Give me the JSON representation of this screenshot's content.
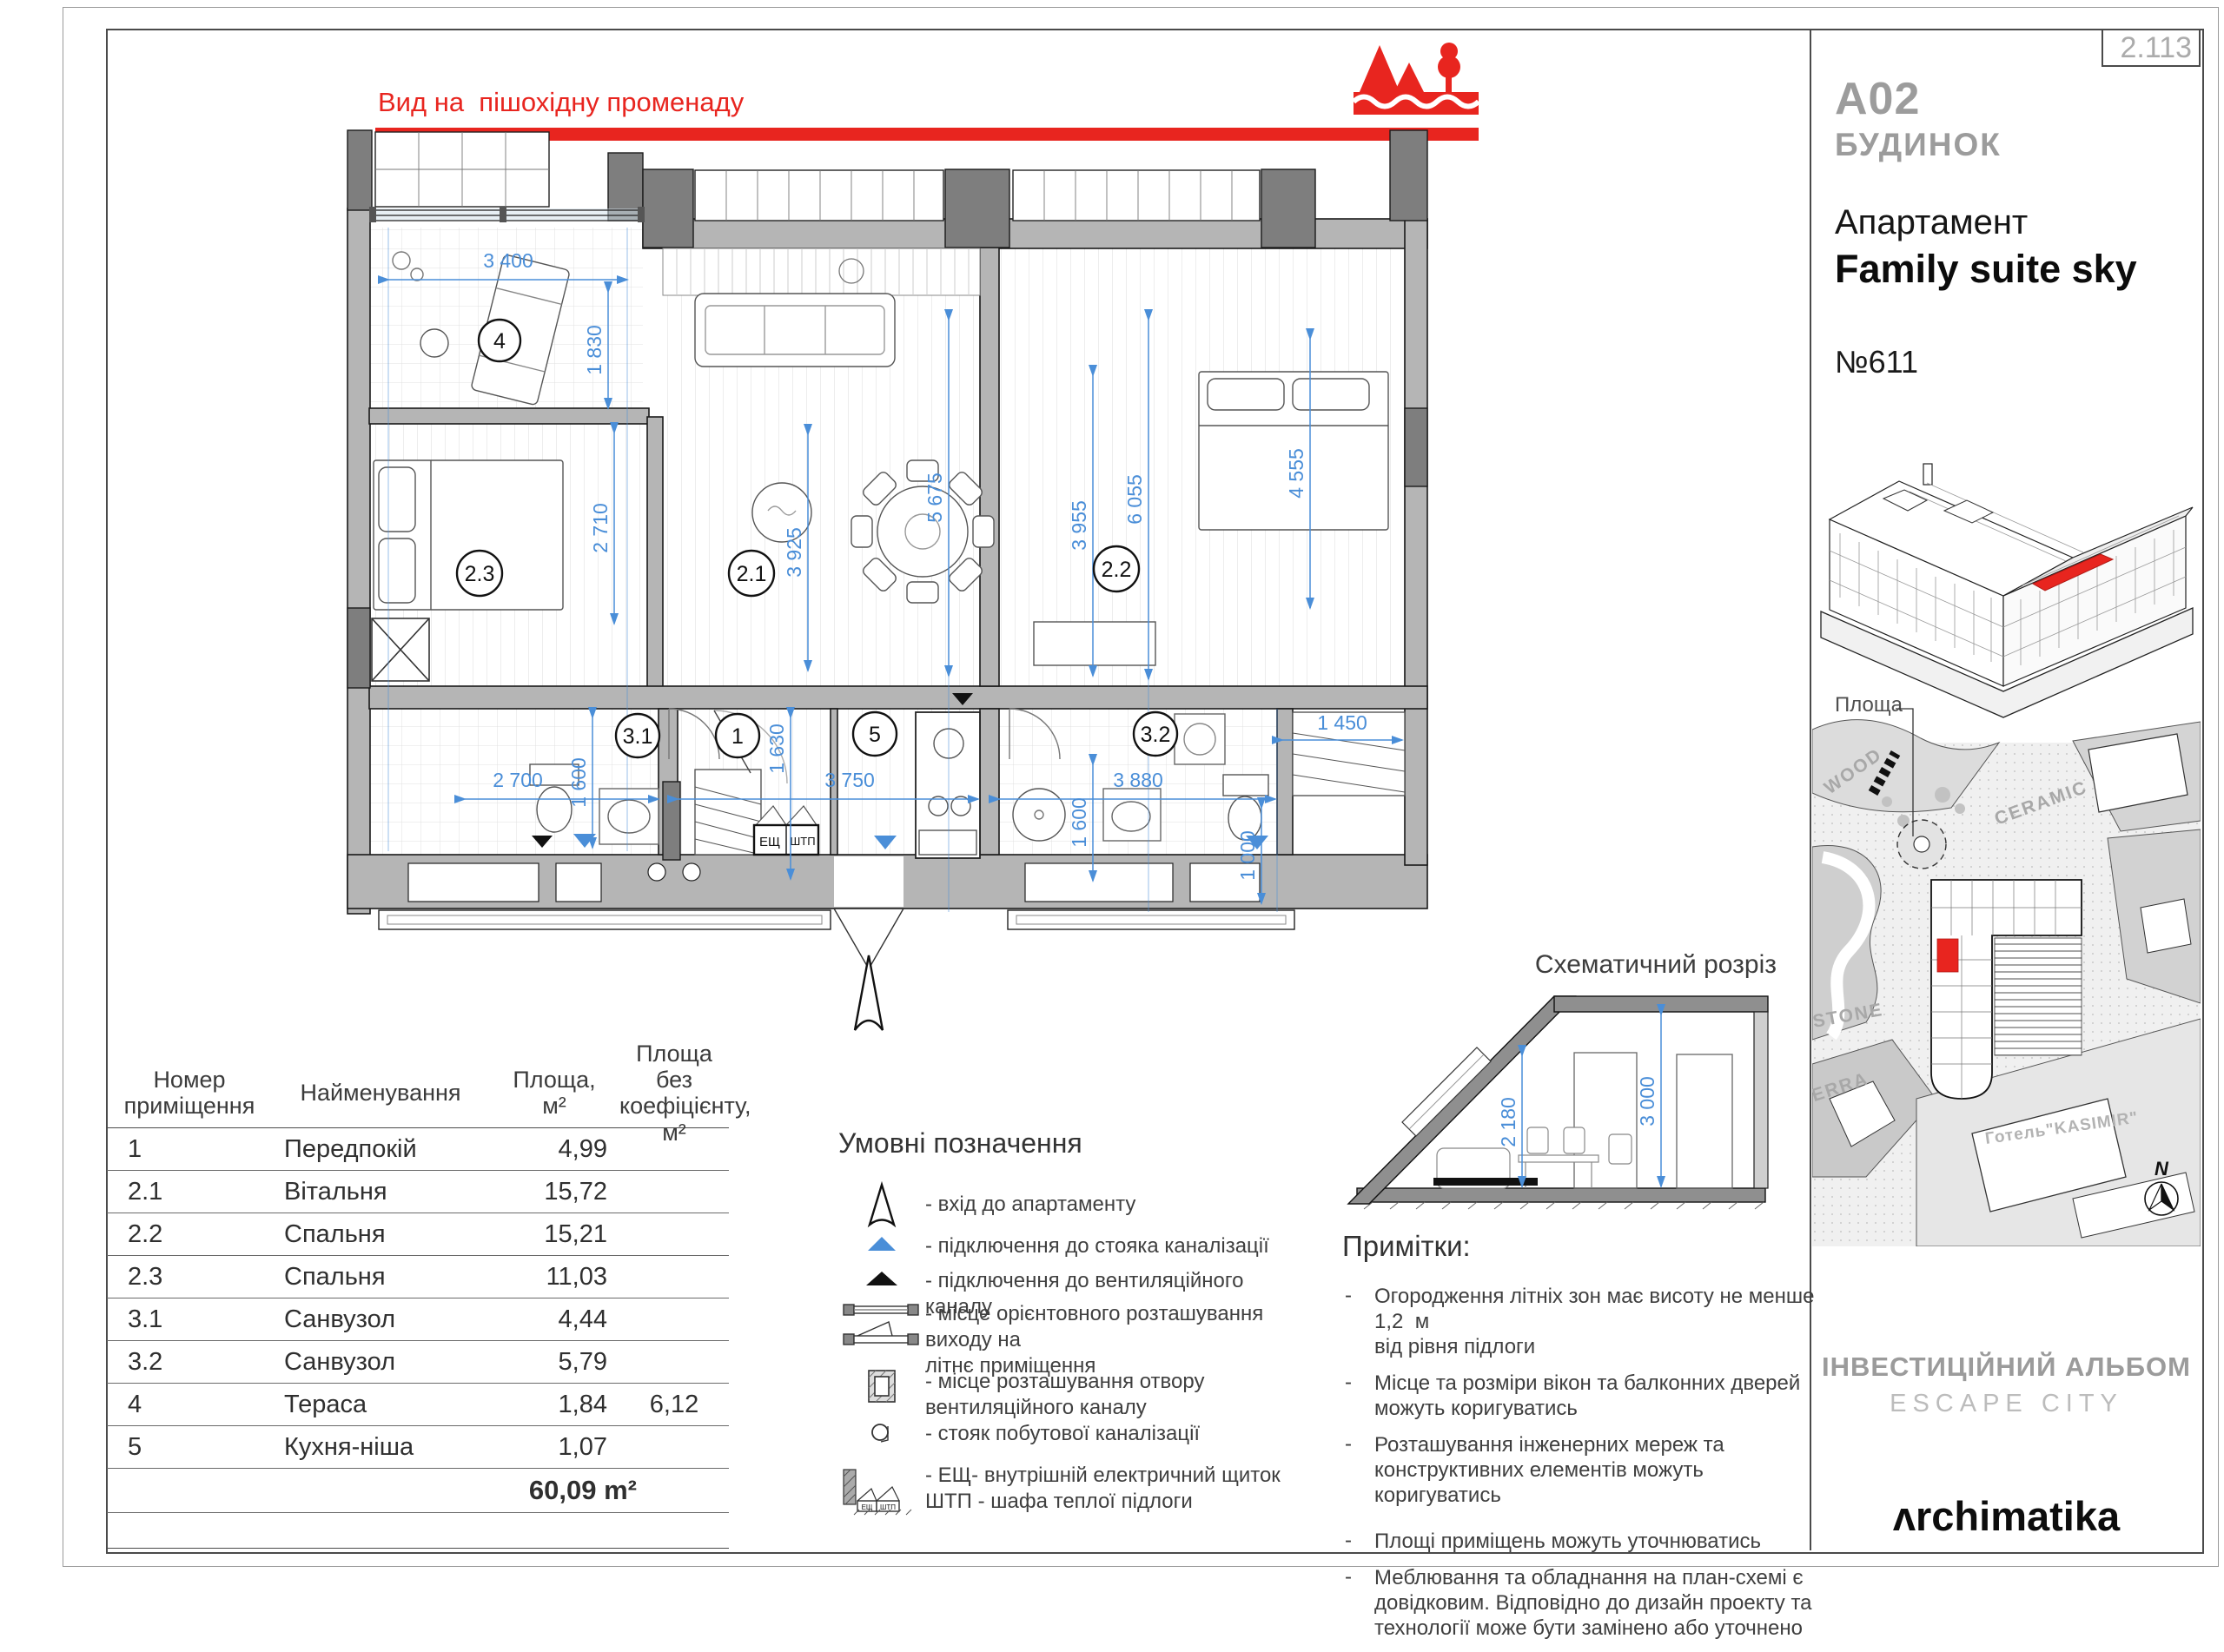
{
  "page_ref": "2.113",
  "view_label": "Вид на  пішохідну променаду",
  "plan": {
    "rooms": {
      "r4": "4",
      "r23": "2.3",
      "r21": "2.1",
      "r22": "2.2",
      "r31": "3.1",
      "r1": "1",
      "r5": "5",
      "r32": "3.2"
    },
    "dims": {
      "terrace_w": "3 400",
      "terrace_d": "1 830",
      "bed23_h": "2 710",
      "living_h1": "3 925",
      "living_h2": "5 675",
      "bed22_h1": "3 955",
      "bed22_h2": "6 055",
      "bed22_h3": "4 555",
      "bath31_h": "1 600",
      "bath31_w": "2 700",
      "hall_h": "1 630",
      "hall_w": "3 750",
      "bath32_w": "3 880",
      "bath32_h": "1 600",
      "bath32_h2": "1 000",
      "closet_w": "1 450"
    },
    "esh_label": "ЕЩ",
    "shtp_label": "ШТП"
  },
  "section": {
    "title": "Схематичний розріз",
    "dim_inner": "2 180",
    "dim_outer": "3 000"
  },
  "table": {
    "headers": [
      "Номер\nприміщення",
      "Найменування",
      "Площа,\nм²",
      "Площа без\nкоефіцієнту,\nм²"
    ],
    "rows": [
      {
        "num": "1",
        "name": "Передпокій",
        "area": "4,99",
        "area_nocoef": ""
      },
      {
        "num": "2.1",
        "name": "Вітальня",
        "area": "15,72",
        "area_nocoef": ""
      },
      {
        "num": "2.2",
        "name": "Спальня",
        "area": "15,21",
        "area_nocoef": ""
      },
      {
        "num": "2.3",
        "name": "Спальня",
        "area": "11,03",
        "area_nocoef": ""
      },
      {
        "num": "3.1",
        "name": "Санвузол",
        "area": "4,44",
        "area_nocoef": ""
      },
      {
        "num": "3.2",
        "name": "Санвузол",
        "area": "5,79",
        "area_nocoef": ""
      },
      {
        "num": "4",
        "name": "Тераса",
        "area": "1,84",
        "area_nocoef": "6,12"
      },
      {
        "num": "5",
        "name": "Кухня-ніша",
        "area": "1,07",
        "area_nocoef": ""
      }
    ],
    "total": "60,09 m²"
  },
  "legend": {
    "title": "Умовні позначення",
    "items": [
      "- вхід до апартаменту",
      "- підключення до стояка каналізації",
      "- підключення до вентиляційного каналу",
      "- місце орієнтовного розташування виходу на\nлітнє приміщення",
      "- місце розташування отвору\nвентиляційного каналу",
      "- стояк побутової каналізації",
      "- ЕЩ- внутрішній електричний щиток\nШТП - шафа теплої підлоги"
    ]
  },
  "notes": {
    "title": "Примітки:",
    "dash": "-",
    "items": [
      "Огородження літніх зон має висоту не менше 1,2  м\nвід рівня підлоги",
      "Місце та розміри вікон та балконних дверей\nможуть коригуватись",
      "Розташування інженерних мереж та\nконструктивних елементів можуть коригуватись",
      "Площі приміщень можуть уточнюватись",
      "Меблювання та обладнання на план-схемі є\nдовідковим. Відповідно до дизайн проекту та\nтехнології може бути замінено або уточнено"
    ]
  },
  "sidebar": {
    "building_code": "A02",
    "building_label": "БУДИНОК",
    "apartment_label": "Апартамент",
    "apartment_name": "Family suite sky",
    "apartment_number": "№611",
    "map_square_label": "Площа",
    "map": {
      "wood": "WOOD",
      "ceramic": "CERAMIC",
      "stone": "STONE",
      "terra": "TERRA",
      "hotel": "Готель\"KASIMIR\"",
      "north": "N"
    },
    "album_title": "ІНВЕСТИЦІЙНИЙ АЛЬБОМ",
    "album_subtitle": "ESCAPE CITY",
    "logo": "ʌrchimatika"
  },
  "colors": {
    "accent_red": "#e8251f",
    "dim_blue": "#4a8ed8"
  }
}
